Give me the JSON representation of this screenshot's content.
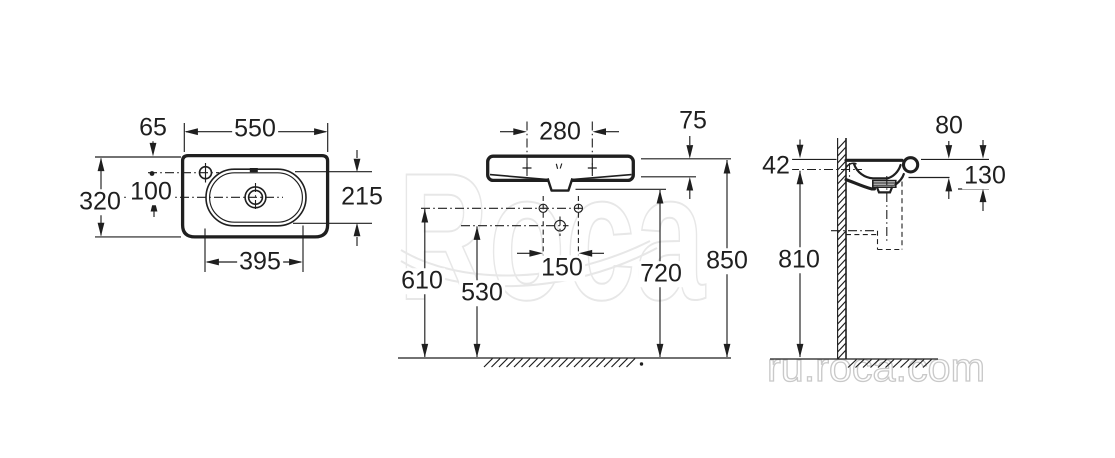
{
  "watermark": {
    "logo_text": "Roca",
    "site_text": "ru.roca.com"
  },
  "views": {
    "top": {
      "dims": {
        "tap_offset_y": "65",
        "overall_width": "550",
        "overall_depth": "320",
        "tap_to_drain": "100",
        "rim_to_bowl_front": "215",
        "bowl_width": "395"
      }
    },
    "front": {
      "dims": {
        "fixing_spacing": "280",
        "apron_height": "75",
        "supply_spacing": "150",
        "supply_height": "610",
        "drain_height": "530",
        "underside_height": "720",
        "rim_height": "850"
      }
    },
    "side": {
      "dims": {
        "rim_to_fixing": "42",
        "rim_to_lip": "80",
        "rim_to_underside": "130",
        "fixing_height": "810"
      }
    }
  }
}
